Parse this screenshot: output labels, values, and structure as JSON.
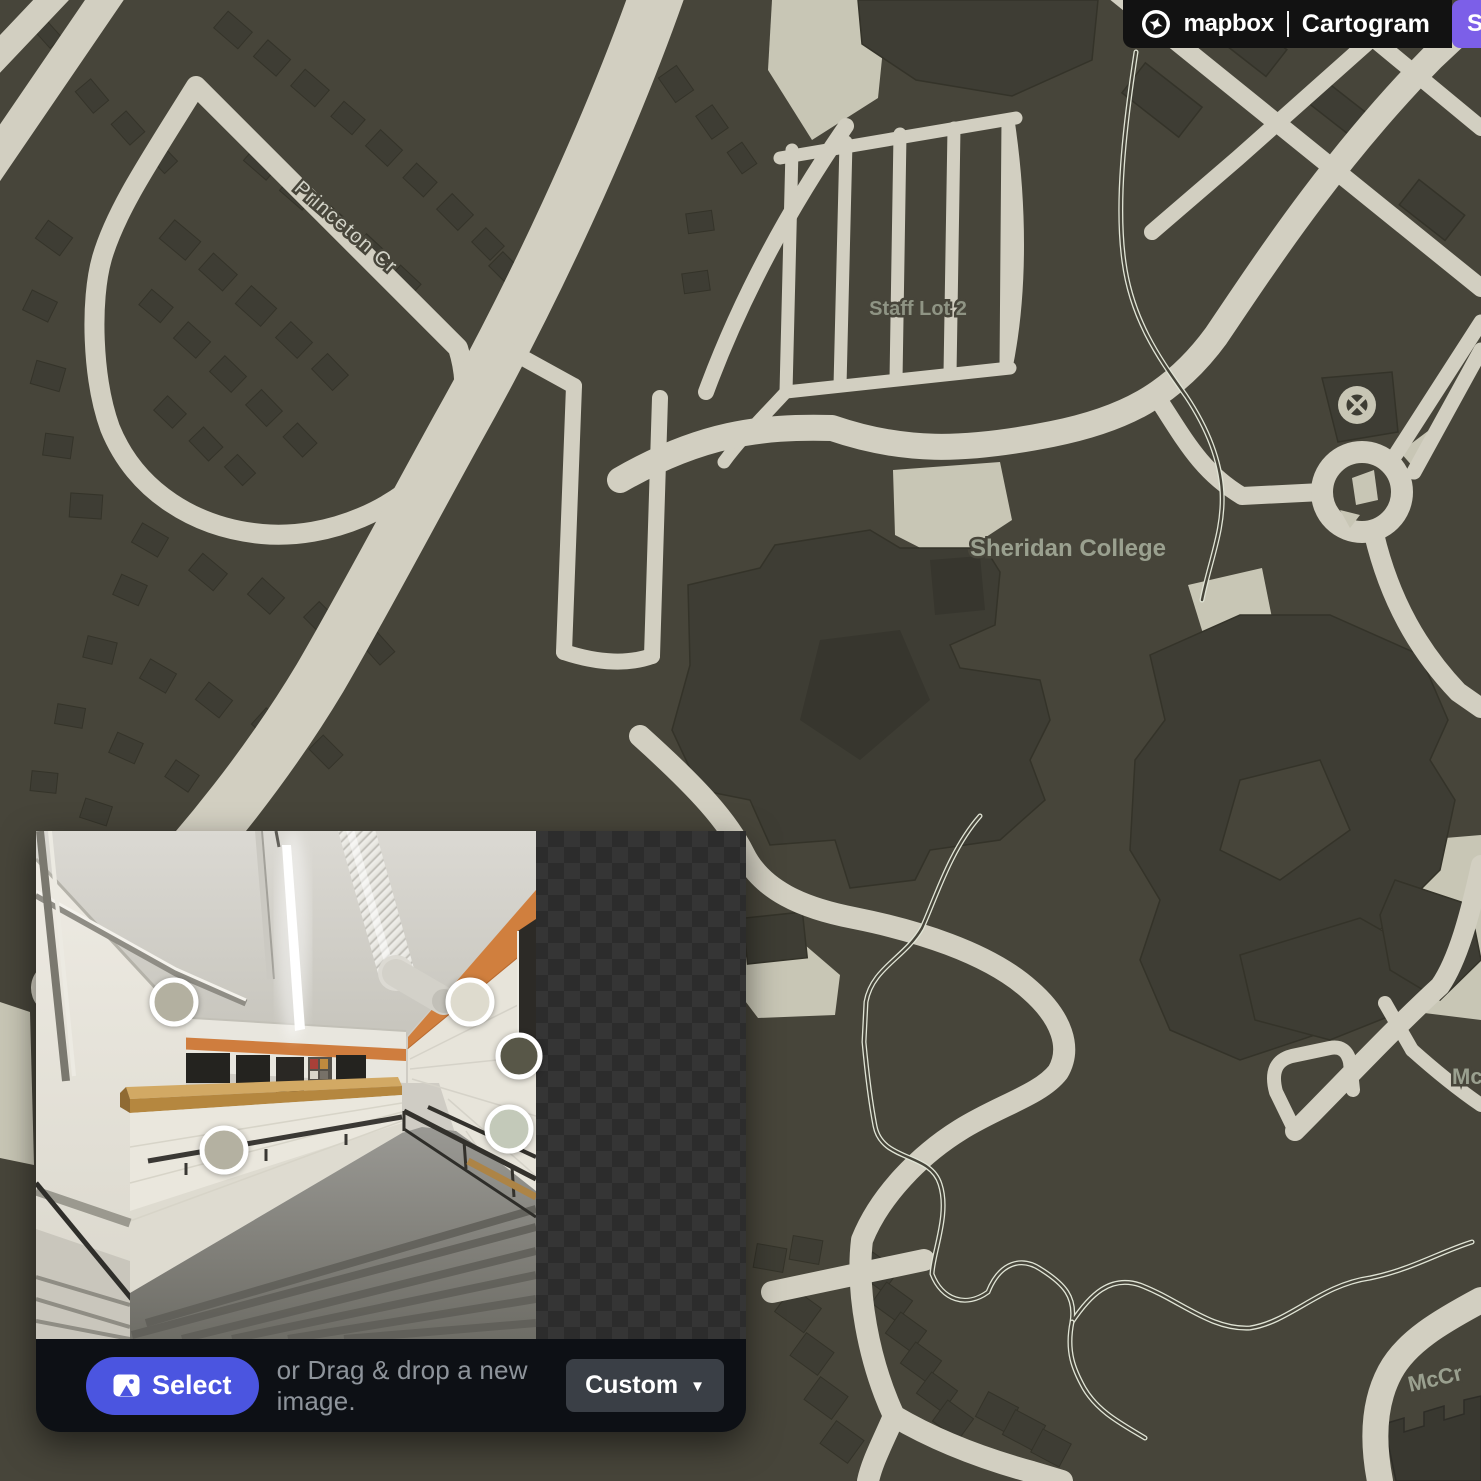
{
  "header": {
    "brand": "mapbox",
    "app_title": "Cartogram",
    "action_button_label": "S",
    "action_button_color": "#7c5fe8"
  },
  "map": {
    "labels": {
      "street": "Princeton Cr",
      "lot": "Staff Lot 2",
      "college": "Sheridan College",
      "mc": "Mc",
      "mccr": "McCr"
    },
    "colors": {
      "background": "#47453a",
      "road": "#d2cfc1",
      "building": "#3e3d34",
      "land": "#c8c6b5",
      "footpath": "#e0e4d5",
      "place_label": "#99a08f",
      "street_label": "#d2d3c8"
    }
  },
  "image_panel": {
    "swatches": [
      {
        "name": "warm-gray",
        "color": "#b3b0a0"
      },
      {
        "name": "warm-gray-2",
        "color": "#b4b1a1"
      },
      {
        "name": "cream",
        "color": "#dedbce"
      },
      {
        "name": "dark-olive",
        "color": "#585748"
      },
      {
        "name": "sage",
        "color": "#c3c9b9"
      }
    ],
    "toolbar": {
      "select_label": "Select",
      "drag_text": "or Drag & drop a new image.",
      "preset_label": "Custom"
    }
  }
}
